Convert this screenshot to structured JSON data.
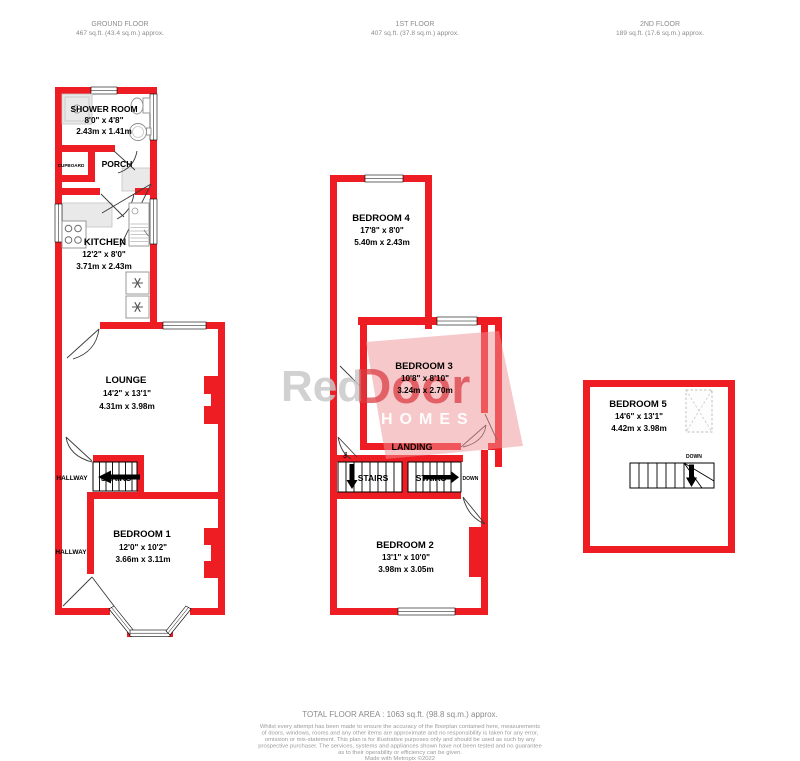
{
  "colors": {
    "wall": "#ee1c23",
    "muted": "#8c8c8c",
    "wm-pink": "#ef9196",
    "wm-gray": "#c9c9c9",
    "wm-red": "#da3a40"
  },
  "headers": {
    "floors": [
      {
        "title": "GROUND FLOOR",
        "area": "467 sq.ft. (43.4 sq.m.) approx."
      },
      {
        "title": "1ST FLOOR",
        "area": "407 sq.ft. (37.8 sq.m.) approx."
      },
      {
        "title": "2ND FLOOR",
        "area": "189 sq.ft. (17.6 sq.m.) approx."
      }
    ]
  },
  "ground_floor": {
    "rooms": {
      "shower_room": {
        "name": "SHOWER ROOM",
        "imperial": "8'0\" x 4'8\"",
        "metric": "2.43m x 1.41m"
      },
      "kitchen": {
        "name": "KITCHEN",
        "imperial": "12'2\" x 8'0\"",
        "metric": "3.71m x 2.43m"
      },
      "lounge": {
        "name": "LOUNGE",
        "imperial": "14'2\" x 13'1\"",
        "metric": "4.31m x 3.98m"
      },
      "bedroom1": {
        "name": "BEDROOM 1",
        "imperial": "12'0\" x 10'2\"",
        "metric": "3.66m x 3.11m"
      }
    },
    "labels": {
      "cupboard": "CUPBOARD",
      "porch": "PORCH",
      "hallway_upper": "HALLWAY",
      "hallway_lower": "HALLWAY",
      "stairs": "STAIRS"
    }
  },
  "first_floor": {
    "rooms": {
      "bedroom4": {
        "name": "BEDROOM 4",
        "imperial": "17'8\" x 8'0\"",
        "metric": "5.40m x 2.43m"
      },
      "bedroom3": {
        "name": "BEDROOM 3",
        "imperial": "10'8\" x 8'10\"",
        "metric": "3.24m x 2.70m"
      },
      "bedroom2": {
        "name": "BEDROOM 2",
        "imperial": "13'1\" x 10'0\"",
        "metric": "3.98m x 3.05m"
      }
    },
    "labels": {
      "landing": "LANDING",
      "stairs_left": "STAIRS",
      "stairs_right": "STAIRS",
      "up": "UP",
      "down": "DOWN"
    }
  },
  "second_floor": {
    "rooms": {
      "bedroom5": {
        "name": "BEDROOM 5",
        "imperial": "14'6\" x 13'1\"",
        "metric": "4.42m x 3.98m"
      }
    },
    "labels": {
      "down": "DOWN"
    }
  },
  "watermark": {
    "part1": "Red",
    "part2": "Door",
    "part3": "HOMES"
  },
  "footer": {
    "total_area": "TOTAL FLOOR AREA : 1063 sq.ft. (98.8 sq.m.) approx.",
    "disclaimer_lines": [
      "Whilst every attempt has been made to ensure the accuracy of the floorplan contained here, measurements",
      "of doors, windows, rooms and any other items are approximate and no responsibility is taken for any error,",
      "omission or mis-statement. This plan is for illustrative purposes only and should be used as such by any",
      "prospective purchaser. The services, systems and appliances shown have not been tested and no guarantee",
      "as to their operability or efficiency can be given."
    ],
    "credit": "Made with Metropix ©2022"
  }
}
